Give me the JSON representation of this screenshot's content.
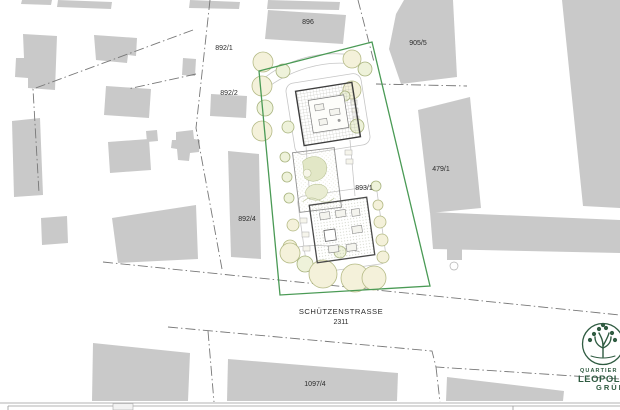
{
  "colors": {
    "building": "#c9c9c9",
    "boundary": "#4a9a55",
    "treefill": "#f4f1da",
    "treestroke": "#b4ba85",
    "line": "#787878",
    "label": "#2b2b2b",
    "logo": "#2f5b41"
  },
  "parcels": [
    {
      "id": "896"
    },
    {
      "id": "892/1"
    },
    {
      "id": "892/2"
    },
    {
      "id": "905/5"
    },
    {
      "id": "479/1"
    },
    {
      "id": "893/1"
    },
    {
      "id": "892/4"
    },
    {
      "id": "1097/4"
    }
  ],
  "street": {
    "name": "SCHÜTZENSTRASSE",
    "number": "2311"
  },
  "logo": {
    "top": "QUARTIER",
    "middle": "LEOPOLD",
    "bottom": "GRÜN"
  }
}
